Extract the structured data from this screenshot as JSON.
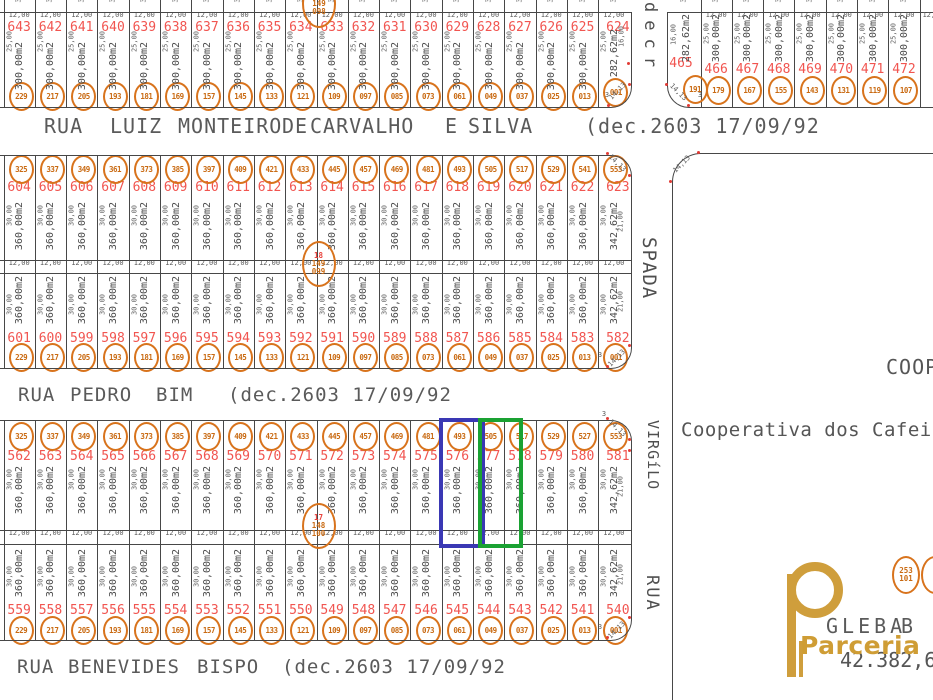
{
  "dims": {
    "arc": "14,13",
    "point": "3"
  },
  "streets": {
    "luiz": {
      "y": 116,
      "size": 20,
      "words": [
        {
          "t": "RUA",
          "x": 44
        },
        {
          "t": "LUIZ",
          "x": 110
        },
        {
          "t": "MONTEIRO",
          "x": 178
        },
        {
          "t": "DE",
          "x": 282
        },
        {
          "t": "CARVALHO",
          "x": 310
        },
        {
          "t": "E",
          "x": 445
        },
        {
          "t": "SILVA",
          "x": 468
        },
        {
          "t": "(dec.2603 17/09/92",
          "x": 585
        }
      ]
    },
    "pedro": {
      "y": 386,
      "size": 19,
      "words": [
        {
          "t": "RUA",
          "x": 18
        },
        {
          "t": "PEDRO",
          "x": 70
        },
        {
          "t": "BIM",
          "x": 156
        },
        {
          "t": "(dec.2603 17/09/92",
          "x": 228
        }
      ]
    },
    "benevides": {
      "y": 658,
      "size": 19,
      "words": [
        {
          "t": "RUA",
          "x": 17
        },
        {
          "t": "BENEVIDES",
          "x": 68
        },
        {
          "t": "BISPO",
          "x": 197
        },
        {
          "t": "(dec.2603 17/09/92",
          "x": 282
        }
      ]
    }
  },
  "blocks": {
    "quadra1_row": {
      "area": "300,00m2",
      "end_area": "282,62m2",
      "side": "25,00",
      "end_side": "16,00",
      "width": "12,00",
      "lots": [
        {
          "n": "643",
          "t": "229"
        },
        {
          "n": "642",
          "t": "217"
        },
        {
          "n": "641",
          "t": "205"
        },
        {
          "n": "640",
          "t": "193"
        },
        {
          "n": "639",
          "t": "181"
        },
        {
          "n": "638",
          "t": "169"
        },
        {
          "n": "637",
          "t": "157"
        },
        {
          "n": "636",
          "t": "145"
        },
        {
          "n": "635",
          "t": "133"
        },
        {
          "n": "634",
          "t": "121"
        },
        {
          "n": "633",
          "t": "109"
        },
        {
          "n": "632",
          "t": "097"
        },
        {
          "n": "631",
          "t": "085"
        },
        {
          "n": "630",
          "t": "073"
        },
        {
          "n": "629",
          "t": "061"
        },
        {
          "n": "628",
          "t": "049"
        },
        {
          "n": "627",
          "t": "037"
        },
        {
          "n": "626",
          "t": "025"
        },
        {
          "n": "625",
          "t": "013"
        },
        {
          "n": "624",
          "t": "001",
          "end": true
        }
      ]
    },
    "quadra_ne": {
      "area": "300,00m2",
      "corner_area": "282,62m2",
      "side": "25,00",
      "corner_side": "16,00",
      "width": "12,00",
      "lots": [
        {
          "n": "465",
          "t": "191",
          "corner": true
        },
        {
          "n": "466",
          "t": "179"
        },
        {
          "n": "467",
          "t": "167"
        },
        {
          "n": "468",
          "t": "155"
        },
        {
          "n": "469",
          "t": "143"
        },
        {
          "n": "470",
          "t": "131"
        },
        {
          "n": "471",
          "t": "119"
        },
        {
          "n": "472",
          "t": "107"
        }
      ]
    },
    "quadra2_top": {
      "area": "360,00m2",
      "end_area": "342,62m2",
      "side": "30,00",
      "end_side": "21,00",
      "width": "12,00",
      "lots": [
        {
          "n": "604",
          "t": "325"
        },
        {
          "n": "605",
          "t": "337"
        },
        {
          "n": "606",
          "t": "349"
        },
        {
          "n": "607",
          "t": "361"
        },
        {
          "n": "608",
          "t": "373"
        },
        {
          "n": "609",
          "t": "385"
        },
        {
          "n": "610",
          "t": "397"
        },
        {
          "n": "611",
          "t": "409"
        },
        {
          "n": "612",
          "t": "421"
        },
        {
          "n": "613",
          "t": "433"
        },
        {
          "n": "614",
          "t": "445"
        },
        {
          "n": "615",
          "t": "457"
        },
        {
          "n": "616",
          "t": "469"
        },
        {
          "n": "617",
          "t": "481"
        },
        {
          "n": "618",
          "t": "493"
        },
        {
          "n": "619",
          "t": "505"
        },
        {
          "n": "620",
          "t": "517"
        },
        {
          "n": "621",
          "t": "529"
        },
        {
          "n": "622",
          "t": "541"
        },
        {
          "n": "623",
          "t": "553",
          "end": true
        }
      ]
    },
    "quadra2_bottom": {
      "area": "360,00m2",
      "end_area": "342,62m2",
      "side": "30,00",
      "end_side": "21,00",
      "width": "12,00",
      "lots": [
        {
          "n": "601",
          "t": "229"
        },
        {
          "n": "600",
          "t": "217"
        },
        {
          "n": "599",
          "t": "205"
        },
        {
          "n": "598",
          "t": "193"
        },
        {
          "n": "597",
          "t": "181"
        },
        {
          "n": "596",
          "t": "169"
        },
        {
          "n": "595",
          "t": "157"
        },
        {
          "n": "594",
          "t": "145"
        },
        {
          "n": "593",
          "t": "133"
        },
        {
          "n": "592",
          "t": "121"
        },
        {
          "n": "591",
          "t": "109"
        },
        {
          "n": "590",
          "t": "097"
        },
        {
          "n": "589",
          "t": "085"
        },
        {
          "n": "588",
          "t": "073"
        },
        {
          "n": "587",
          "t": "061"
        },
        {
          "n": "586",
          "t": "049"
        },
        {
          "n": "585",
          "t": "037"
        },
        {
          "n": "584",
          "t": "025"
        },
        {
          "n": "583",
          "t": "013"
        },
        {
          "n": "582",
          "t": "001",
          "end": true
        }
      ]
    },
    "quadra3_top": {
      "area": "360,00m2",
      "end_area": "342,62m2",
      "side": "30,00",
      "end_side": "21,00",
      "width": "12,00",
      "lots": [
        {
          "n": "562",
          "t": "325"
        },
        {
          "n": "563",
          "t": "337"
        },
        {
          "n": "564",
          "t": "349"
        },
        {
          "n": "565",
          "t": "361"
        },
        {
          "n": "566",
          "t": "373"
        },
        {
          "n": "567",
          "t": "385"
        },
        {
          "n": "568",
          "t": "397"
        },
        {
          "n": "569",
          "t": "409"
        },
        {
          "n": "570",
          "t": "421"
        },
        {
          "n": "571",
          "t": "433"
        },
        {
          "n": "572",
          "t": "445"
        },
        {
          "n": "573",
          "t": "457"
        },
        {
          "n": "574",
          "t": "469"
        },
        {
          "n": "575",
          "t": "481"
        },
        {
          "n": "576",
          "t": "493"
        },
        {
          "n": "577",
          "t": "505"
        },
        {
          "n": "578",
          "t": "517"
        },
        {
          "n": "579",
          "t": "529"
        },
        {
          "n": "580",
          "t": "527"
        },
        {
          "n": "581",
          "t": "553",
          "end": true
        }
      ]
    },
    "quadra3_bottom": {
      "area": "360,00m2",
      "end_area": "342,62m2",
      "side": "30,00",
      "end_side": "21,00",
      "width": "12,00",
      "lots": [
        {
          "n": "559",
          "t": "229"
        },
        {
          "n": "558",
          "t": "217"
        },
        {
          "n": "557",
          "t": "205"
        },
        {
          "n": "556",
          "t": "193"
        },
        {
          "n": "555",
          "t": "181"
        },
        {
          "n": "554",
          "t": "169"
        },
        {
          "n": "553",
          "t": "157"
        },
        {
          "n": "552",
          "t": "145"
        },
        {
          "n": "551",
          "t": "133"
        },
        {
          "n": "550",
          "t": "121"
        },
        {
          "n": "549",
          "t": "109"
        },
        {
          "n": "548",
          "t": "097"
        },
        {
          "n": "547",
          "t": "085"
        },
        {
          "n": "546",
          "t": "073"
        },
        {
          "n": "545",
          "t": "061"
        },
        {
          "n": "544",
          "t": "049"
        },
        {
          "n": "543",
          "t": "037"
        },
        {
          "n": "542",
          "t": "025"
        },
        {
          "n": "541",
          "t": "013"
        },
        {
          "n": "540",
          "t": "001",
          "end": true
        }
      ]
    }
  },
  "markers": [
    {
      "lines": [
        "19",
        "149",
        "098"
      ]
    },
    {
      "l18es": "",
      "lines": [
        "18",
        "149",
        "099"
      ]
    },
    {
      "lines": [
        "17",
        "148",
        "100"
      ]
    },
    {
      "lines": [
        "253",
        "101"
      ]
    },
    {
      "lines": []
    }
  ],
  "vertical_labels": {
    "decree": "decr",
    "spada": "SPADA",
    "virgilo": "VIRGíLO",
    "rua": "RUA"
  },
  "right_area": {
    "coop_partial": "COOP",
    "owner_text": "Cooperativa dos Cafeiculto"
  },
  "gleba": {
    "name": "GLEBA",
    "letter": "B",
    "area": "42.382,68m2"
  },
  "logo": {
    "text": "Parceria"
  },
  "highlights": {
    "blue_lot": "576",
    "blue_color": "#3a38b4",
    "green_lot": "577",
    "green_color": "#1aa233"
  },
  "colors": {
    "line": "#474747",
    "lot_number_red": "#f15550",
    "tag_orange": "#d8731c",
    "dim_gray": "#5d5d5d",
    "street_gray": "#5a5a5a",
    "logo_gold": "#cf9e3c"
  }
}
